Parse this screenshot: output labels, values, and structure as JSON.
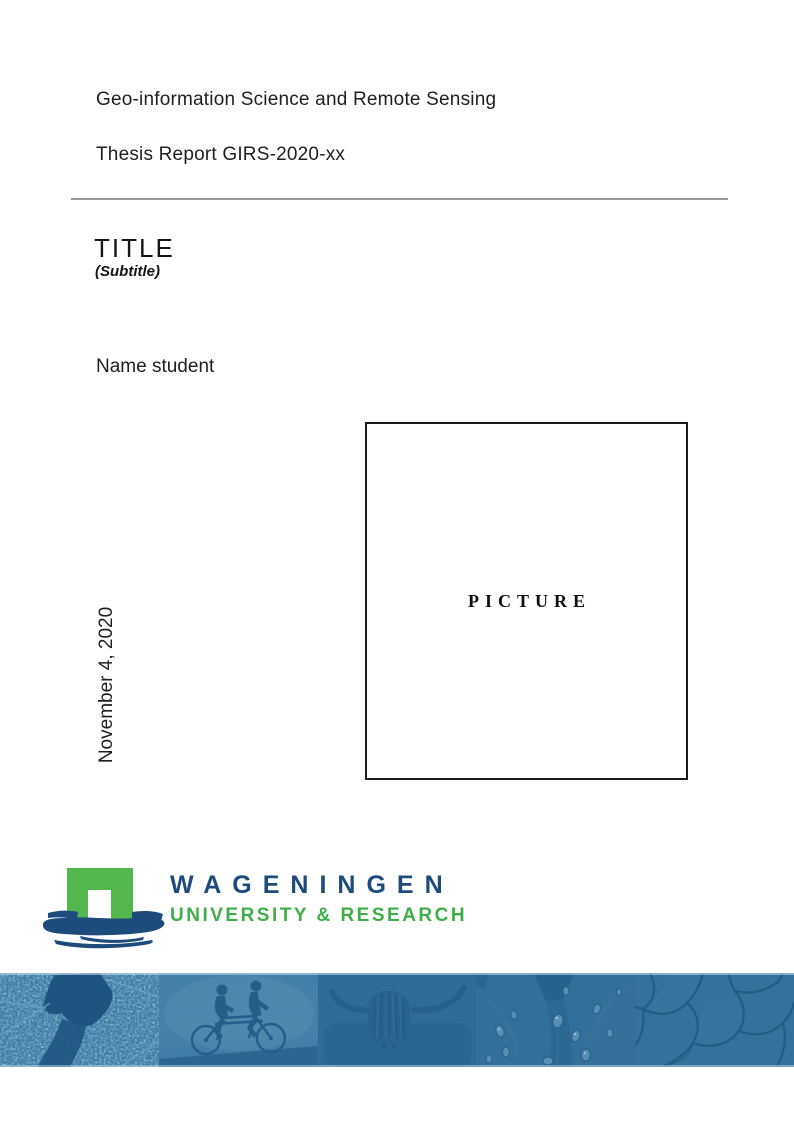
{
  "header": {
    "program": "Geo-information Science and Remote Sensing",
    "report_id": "Thesis Report GIRS-2020-xx"
  },
  "titleblock": {
    "title": "TITLE",
    "subtitle": "(Subtitle)",
    "author": "Name student",
    "date": "November 4, 2020"
  },
  "picture_box": {
    "placeholder": "PICTURE"
  },
  "logo": {
    "wordmark": "WAGENINGEN",
    "tagline": "UNIVERSITY & RESEARCH",
    "mark_green": "#52B84D",
    "mark_blue": "#1D4B7C",
    "wordmark_blue": "#1D4B7C",
    "tagline_green": "#3FAE47"
  },
  "banner": {
    "base_color": "#31709B",
    "images": [
      {
        "name": "aerial-map"
      },
      {
        "name": "tandem-cyclists"
      },
      {
        "name": "highland-cow"
      },
      {
        "name": "leaf-water-droplets"
      },
      {
        "name": "cracked-earth"
      }
    ]
  }
}
